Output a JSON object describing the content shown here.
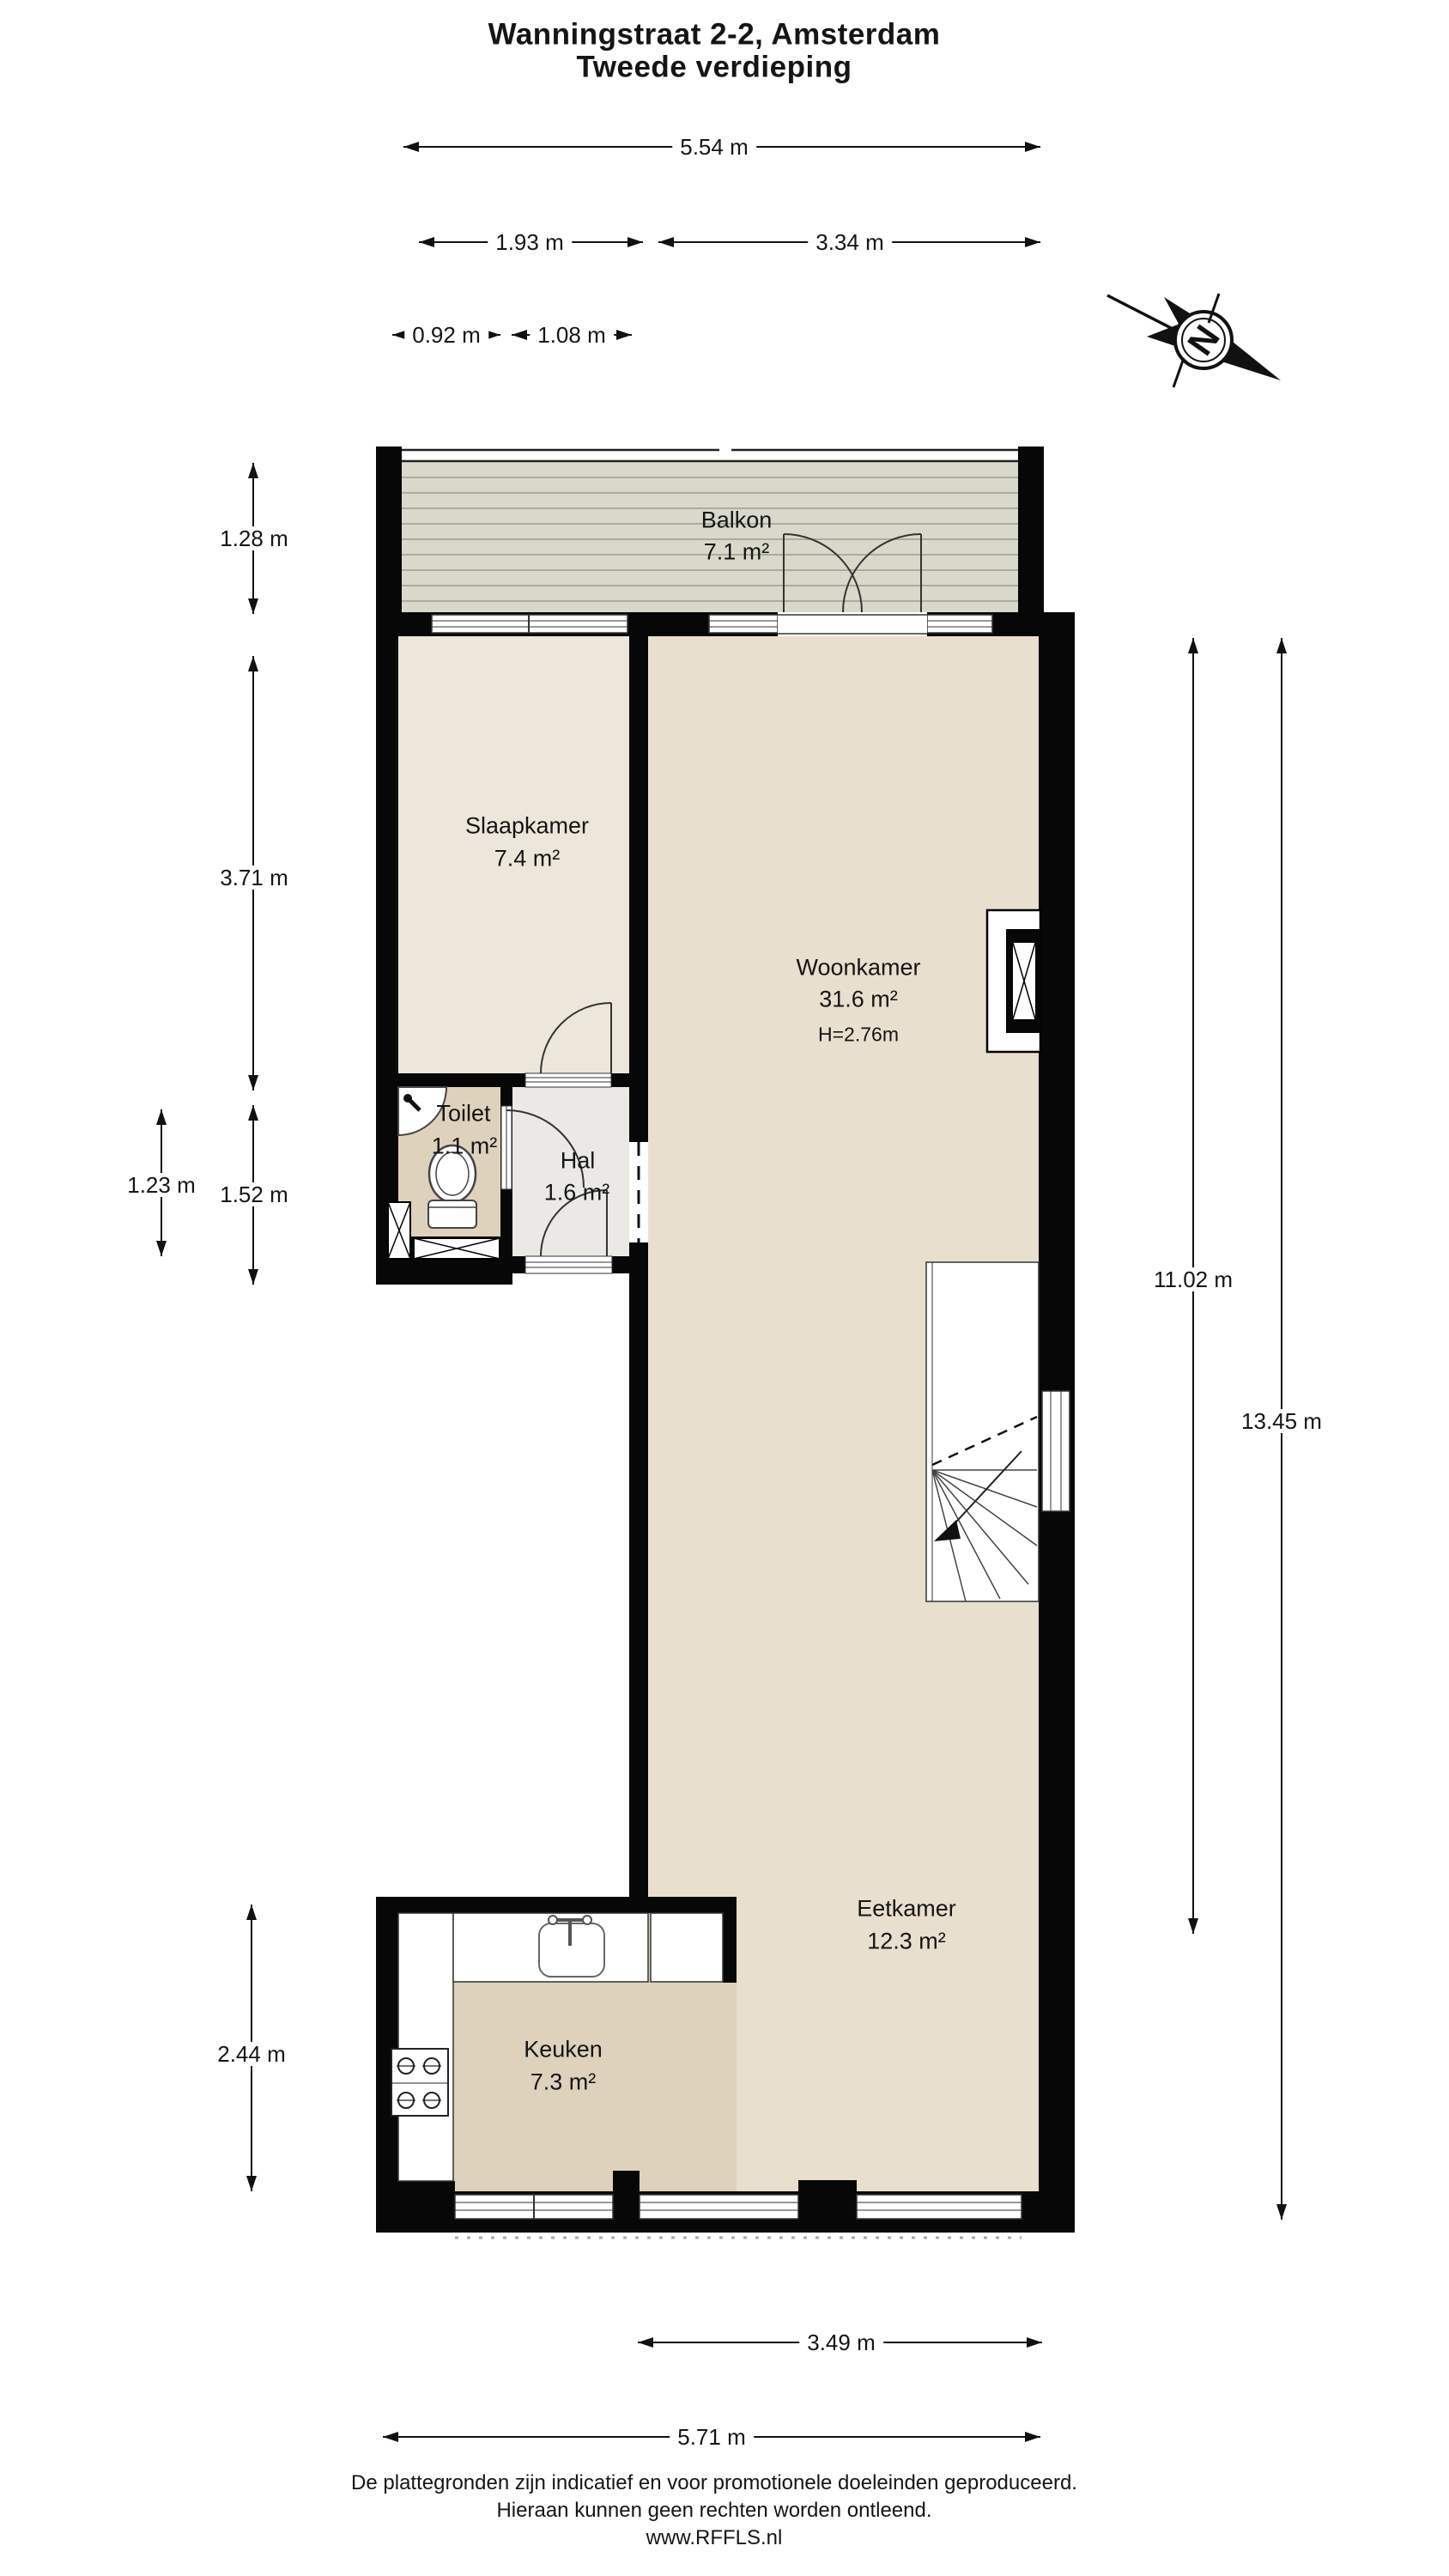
{
  "title": {
    "line1": "Wanningstraat 2-2, Amsterdam",
    "line2": "Tweede verdieping"
  },
  "rooms": {
    "balkon": {
      "name": "Balkon",
      "area": "7.1 m²"
    },
    "slaapkamer": {
      "name": "Slaapkamer",
      "area": "7.4 m²"
    },
    "woonkamer": {
      "name": "Woonkamer",
      "area": "31.6 m²",
      "ceiling": "H=2.76m"
    },
    "toilet": {
      "name": "Toilet",
      "area": "1.1 m²"
    },
    "hal": {
      "name": "Hal",
      "area": "1.6 m²"
    },
    "eetkamer": {
      "name": "Eetkamer",
      "area": "12.3 m²"
    },
    "keuken": {
      "name": "Keuken",
      "area": "7.3 m²"
    }
  },
  "dimensions": {
    "top_total": "5.54 m",
    "top_left": "1.93 m",
    "top_right": "3.34 m",
    "toilet_width": "0.92 m",
    "hal_width": "1.08 m",
    "balcony_depth": "1.28 m",
    "slaapkamer_depth": "3.71 m",
    "toilet_depth": "1.23 m",
    "left_lower": "1.52 m",
    "keuken_depth": "2.44 m",
    "interior_length": "11.02 m",
    "total_length": "13.45 m",
    "eetkamer_width": "3.49 m",
    "bottom_total": "5.71 m"
  },
  "compass": {
    "north": "N"
  },
  "footer": {
    "line1": "De plattegronden zijn indicatief en voor promotionele doeleinden geproduceerd.",
    "line2": "Hieraan kunnen geen rechten worden ontleend.",
    "line3": "www.RFFLS.nl"
  },
  "colors": {
    "wall": "#070707",
    "balkon_floor": "#d8d8cb",
    "balkon_plank_line": "#abab9e",
    "living_floor": "#e8dfce",
    "slaapkamer_floor": "#ece7da",
    "wet_room_floor": "#ded2bd",
    "hal_floor": "#eae9e5"
  }
}
